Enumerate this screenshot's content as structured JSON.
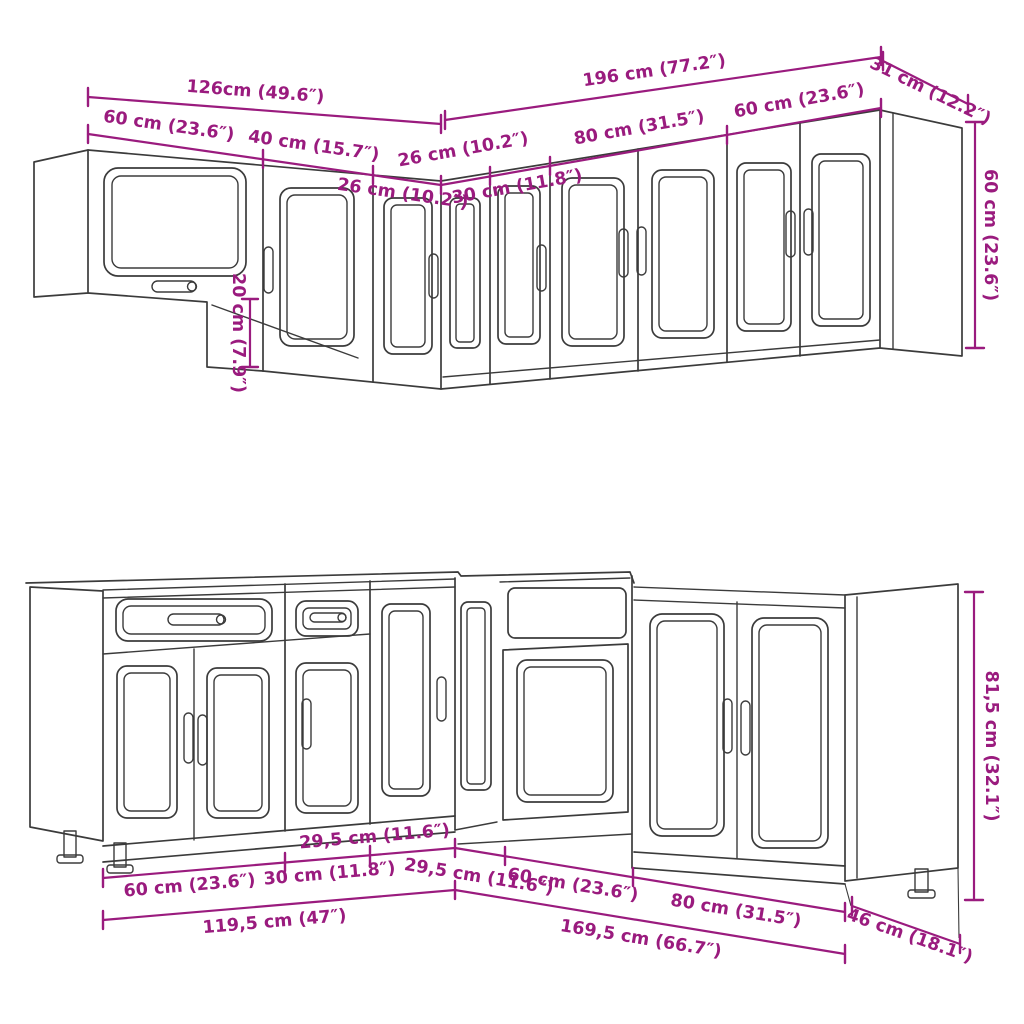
{
  "diagram": {
    "kind": "kitchen-cabinet-set-dimension-drawing",
    "colors": {
      "dimension": "#9A1B7E",
      "outline": "#3B3B3B",
      "background": "#FFFFFF"
    },
    "wall": {
      "total_left": "126cm (49.6″)",
      "total_right": "196 cm (77.2″)",
      "depth_right": "31 cm (12.2″)",
      "seg_left_1": "60 cm (23.6″)",
      "seg_left_2": "40 cm (15.7″)",
      "seg_left_3": "26 cm (10.2″)",
      "seg_right_1": "26 cm (10.2″)",
      "seg_right_2": "30 cm (11.8″)",
      "seg_right_3": "80 cm (31.5″)",
      "seg_right_4": "60 cm (23.6″)",
      "height_right": "60 cm (23.6″)",
      "bridge_gap": "20 cm (7.9″)"
    },
    "base": {
      "seg_left_1": "60 cm (23.6″)",
      "seg_left_2": "30 cm (11.8″)",
      "seg_left_3": "29,5 cm (11.6″)",
      "total_left": "119,5 cm (47″)",
      "seg_right_1": "29,5 cm (11.6″)",
      "seg_right_2": "60 cm (23.6″)",
      "seg_right_3": "80 cm (31.5″)",
      "total_right": "169,5 cm (66.7″)",
      "depth_right": "46 cm (18.1″)",
      "height_right": "81,5 cm (32.1″)"
    }
  }
}
